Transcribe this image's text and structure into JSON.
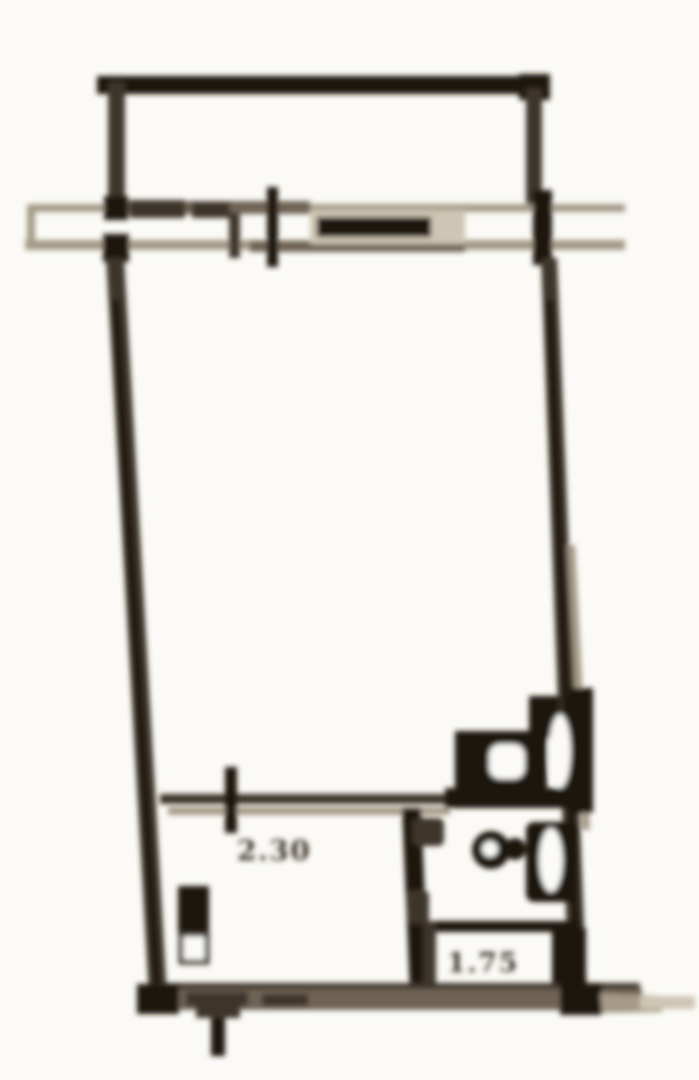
{
  "document": {
    "type": "scanned floor plan",
    "description": "Blurry sepia scan of a studio apartment unit floor plan: balcony at top, facade wall with window, large main room, kitchen nook and bathroom with tub at bottom"
  },
  "labels": {
    "kitchen_dimension": "2.30",
    "bathtub_dimension": "1.75"
  },
  "rooms": [
    {
      "name": "balcony",
      "position": "top"
    },
    {
      "name": "main-room",
      "position": "center"
    },
    {
      "name": "kitchen-nook",
      "position": "bottom-left",
      "dimension": "2.30"
    },
    {
      "name": "bathroom",
      "position": "bottom-right",
      "dimension": "1.75"
    }
  ],
  "fixtures": [
    "balcony-parapet",
    "facade-window-bar",
    "vent-shaft",
    "toilet",
    "sink",
    "bathtub",
    "radiator"
  ],
  "colors": {
    "paper": "#fbfaf6",
    "ink": "#1a120a",
    "ink2": "#3c342a",
    "mid": "#6f6354",
    "light": "#a59a87",
    "faint": "#cfc5b4"
  }
}
